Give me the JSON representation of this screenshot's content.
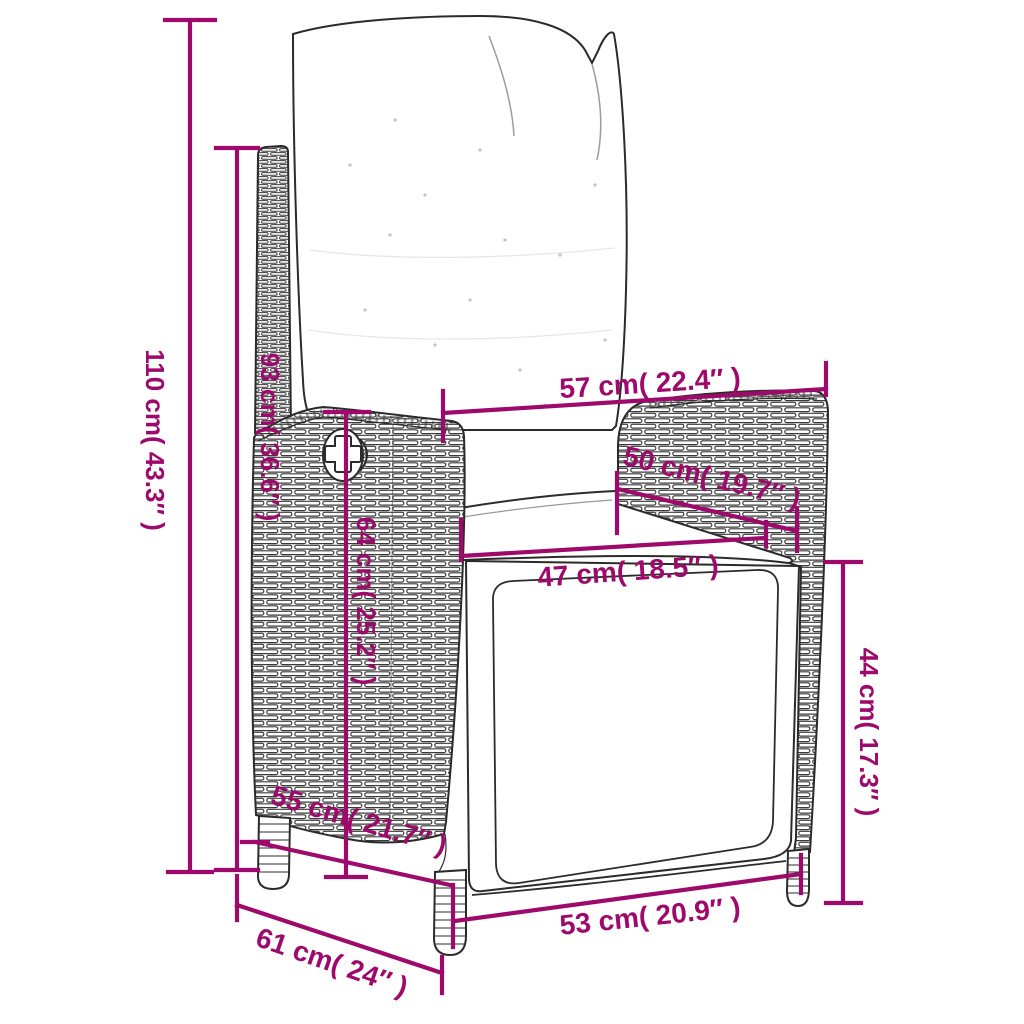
{
  "subject": "Reclining rattan garden chair with cushions - dimension drawing",
  "colors": {
    "dimension": "#9E0A6C",
    "line_art": "#2B2B2B"
  },
  "dimensions": {
    "total_height": {
      "cm": "110",
      "inches": "43.3",
      "label": "110 cm( 43.3″ )"
    },
    "backrest_height": {
      "cm": "93",
      "inches": "36.6",
      "label": "93 cm( 36.6″ )"
    },
    "top_width": {
      "cm": "57",
      "inches": "22.4",
      "label": "57 cm( 22.4″ )"
    },
    "armrest_depth": {
      "cm": "50",
      "inches": "19.7",
      "label": "50 cm( 19.7″ )"
    },
    "seat_width": {
      "cm": "47",
      "inches": "18.5",
      "label": "47 cm( 18.5″ )"
    },
    "armrest_height": {
      "cm": "64",
      "inches": "25.2",
      "label": "64 cm( 25.2″ )"
    },
    "base_height": {
      "cm": "44",
      "inches": "17.3",
      "label": "44 cm( 17.3″ )"
    },
    "seat_depth": {
      "cm": "55",
      "inches": "21.7",
      "label": "55 cm( 21.7″ )"
    },
    "total_depth": {
      "cm": "61",
      "inches": "24",
      "label": "61 cm( 24″ )"
    },
    "front_width": {
      "cm": "53",
      "inches": "20.9",
      "label": "53 cm( 20.9″ )"
    }
  }
}
